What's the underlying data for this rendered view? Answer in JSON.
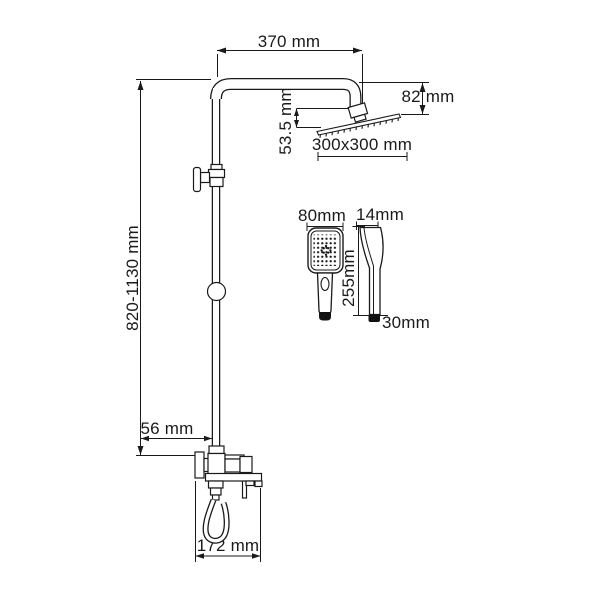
{
  "colors": {
    "line": "#1a1a1a",
    "background": "#ffffff",
    "dark_fill": "#111111"
  },
  "labels": {
    "top_width": "370 mm",
    "head_offset": "82 mm",
    "head_drop": "53.5 mm",
    "head_size": "300x300 mm",
    "column_height": "820-1130 mm",
    "wall_offset": "56 mm",
    "base_width": "172 mm",
    "handshower_width": "80mm",
    "handshower_depth": "14mm",
    "handshower_length": "255mm",
    "handshower_bottom_width": "30mm"
  }
}
